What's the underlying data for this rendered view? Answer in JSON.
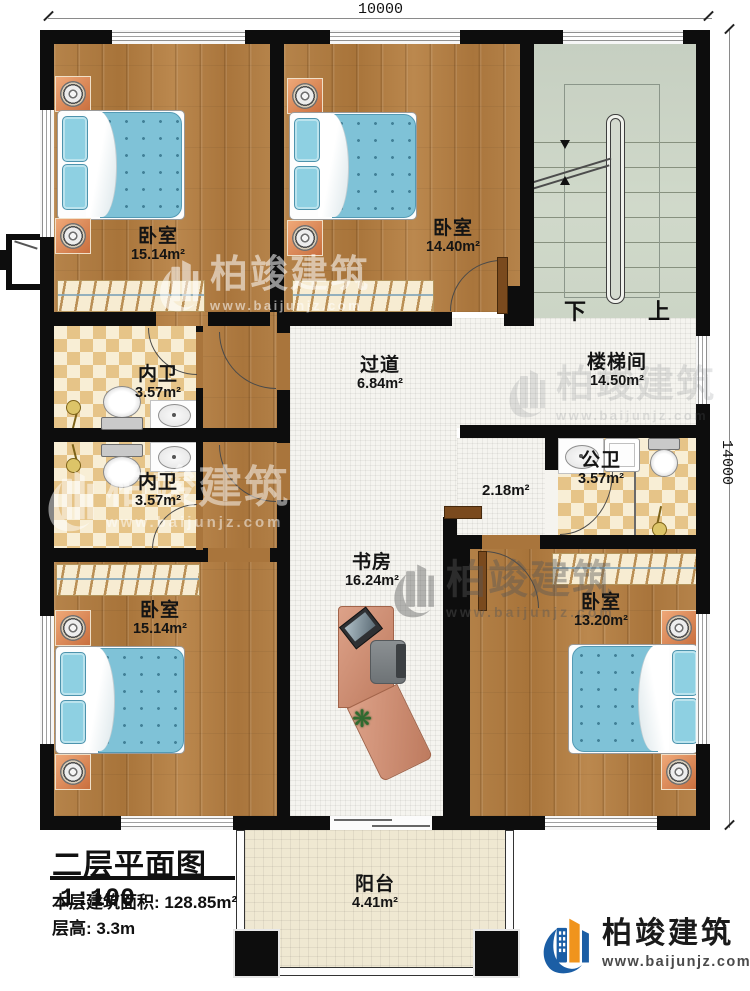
{
  "title_block": {
    "title": "二层平面图",
    "scale": "1:100",
    "area_label": "本层建筑面积: 128.85m²",
    "floor_height_label": "层高: 3.3m"
  },
  "dimensions": {
    "top": "10000",
    "right": "14000"
  },
  "rooms": {
    "bedroom_top_left": {
      "name": "卧室",
      "area": "15.14m²"
    },
    "bedroom_top_mid": {
      "name": "卧室",
      "area": "14.40m²"
    },
    "stairwell": {
      "name": "楼梯间",
      "area": "14.50m²"
    },
    "hallway": {
      "name": "过道",
      "area": "6.84m²"
    },
    "ensuite_upper": {
      "name": "内卫",
      "area": "3.57m²"
    },
    "ensuite_lower": {
      "name": "内卫",
      "area": "3.57m²"
    },
    "public_bath": {
      "name": "公卫",
      "area": "3.57m²"
    },
    "corridor_nook": {
      "area": "2.18m²"
    },
    "study": {
      "name": "书房",
      "area": "16.24m²"
    },
    "bedroom_bottom_left": {
      "name": "卧室",
      "area": "15.14m²"
    },
    "bedroom_bottom_right": {
      "name": "卧室",
      "area": "13.20m²"
    },
    "balcony": {
      "name": "阳台",
      "area": "4.41m²"
    }
  },
  "stairs": {
    "down_label": "下",
    "up_label": "上"
  },
  "branding": {
    "company": "柏竣建筑",
    "website": "www.baijunjz.com"
  },
  "watermark": {
    "company": "柏竣建筑",
    "website": "www.baijunjz.com"
  },
  "colors": {
    "wall": "#0d0d0d",
    "wood": "#b2803f",
    "tile": "#f5f4ef",
    "bath_tile": "#e6c488",
    "stair": "#ccd5c6",
    "bed": "#7fc2d7",
    "brand_blue": "#1b5ea5",
    "brand_orange": "#f0941d"
  }
}
